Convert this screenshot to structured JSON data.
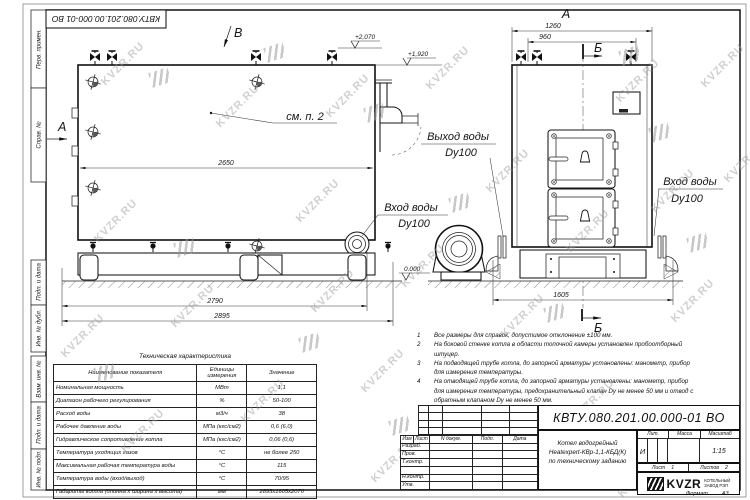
{
  "watermark": {
    "text": "KVZR.RU"
  },
  "stamp_top": "КВТУ.080.201.00.000-01 ВО",
  "frame_labels": {
    "perv": "Перв. примен.",
    "sprav": "Справ. №",
    "podp1": "Подп. и дата",
    "inv_dubl": "Инв. № дубл.",
    "vzam": "Взам. инв. №",
    "podp2": "Подп. и дата",
    "inv_podl": "Инв. № подл."
  },
  "views": {
    "view_a_label": "А",
    "front_title": "А",
    "section_b": "Б",
    "view_v_label": "В",
    "see_note": "см. п. 2",
    "elev_top1": "+2,070",
    "elev_top2": "+1,920",
    "elev_zero": "0.000",
    "water_out": "Выход воды",
    "water_out_dy": "Dy100",
    "water_in": "Вход воды",
    "water_in_dy": "Dy100",
    "water_in2": "Вход воды",
    "water_in2_dy": "Dy100"
  },
  "dimensions": {
    "len_inner": "2650",
    "len_base": "2790",
    "len_total": "2895",
    "front_width": "1260",
    "front_inner": "960",
    "front_base": "1605"
  },
  "tech_table": {
    "title": "Техническая характеристика",
    "headers": [
      "Наименование показателя",
      "Единицы измерения",
      "Значение"
    ],
    "rows": [
      [
        "Номинальная мощность",
        "МВт",
        "1,1"
      ],
      [
        "Диапазон рабочего регулирования",
        "%",
        "50-100"
      ],
      [
        "Расход воды",
        "м3/ч",
        "38"
      ],
      [
        "Рабочее давление воды",
        "МПа (кгс/см2)",
        "0,6 (6,0)"
      ],
      [
        "Гидравлическое сопротивление котла",
        "МПа (кгс/см2)",
        "0,06 (0,6)"
      ],
      [
        "Температура уходящих газов",
        "°С",
        "не более 250"
      ],
      [
        "Максимальная рабочая температура воды",
        "°С",
        "115"
      ],
      [
        "Температура воды (вход/выход)",
        "°С",
        "70/95"
      ],
      [
        "Габариты котла (длинна х ширина х высота)",
        "мм",
        "2895х1605х2070"
      ]
    ]
  },
  "notes": [
    {
      "num": "1",
      "text": "Все размеры для справок, допустимое отклонение ±100 мм."
    },
    {
      "num": "2",
      "text": "На боковой стенке котла в области топочной камеры установлен пробоотборный штуцер."
    },
    {
      "num": "3",
      "text": "На подводящей трубе котла, до запорной арматуры установлены: манометр, прибор для измерения температуры."
    },
    {
      "num": "4",
      "text": "На отводящей трубе котла, до запорной арматуры установлены: манометр, прибор для измерения температуры, предохранительный клапан Dy не менее 50 мм и отвод с обратным клапаном Dy не менее 50 мм."
    }
  ],
  "title_block": {
    "doc_number": "КВТУ.080.201.00.000-01 ВО",
    "rev_headers": [
      "Изм",
      "Лист",
      "N докум.",
      "Подп.",
      "Дата"
    ],
    "roles": [
      "Разраб.",
      "Пров.",
      "Т.контр.",
      "",
      "Н.контр.",
      "Утв."
    ],
    "product_name_1": "Котел водогрейный",
    "product_name_2": "Heatexpert-КВр-1,1-КБД(К)",
    "product_name_3": "по техническому заданию",
    "lit_header": "Лит.",
    "mass_header": "Масса",
    "scale_header": "Масштаб",
    "lit_value": "И",
    "scale_value": "1:15",
    "sheet_label": "Лист",
    "sheet_value": "1",
    "sheets_label": "Листов",
    "sheets_value": "2",
    "company_logo": "KVZR",
    "company_name_1": "КОТЕЛЬНЫЙ",
    "company_name_2": "ЗАВОД РЭП",
    "format_label": "Формат",
    "format_value": "А3"
  }
}
